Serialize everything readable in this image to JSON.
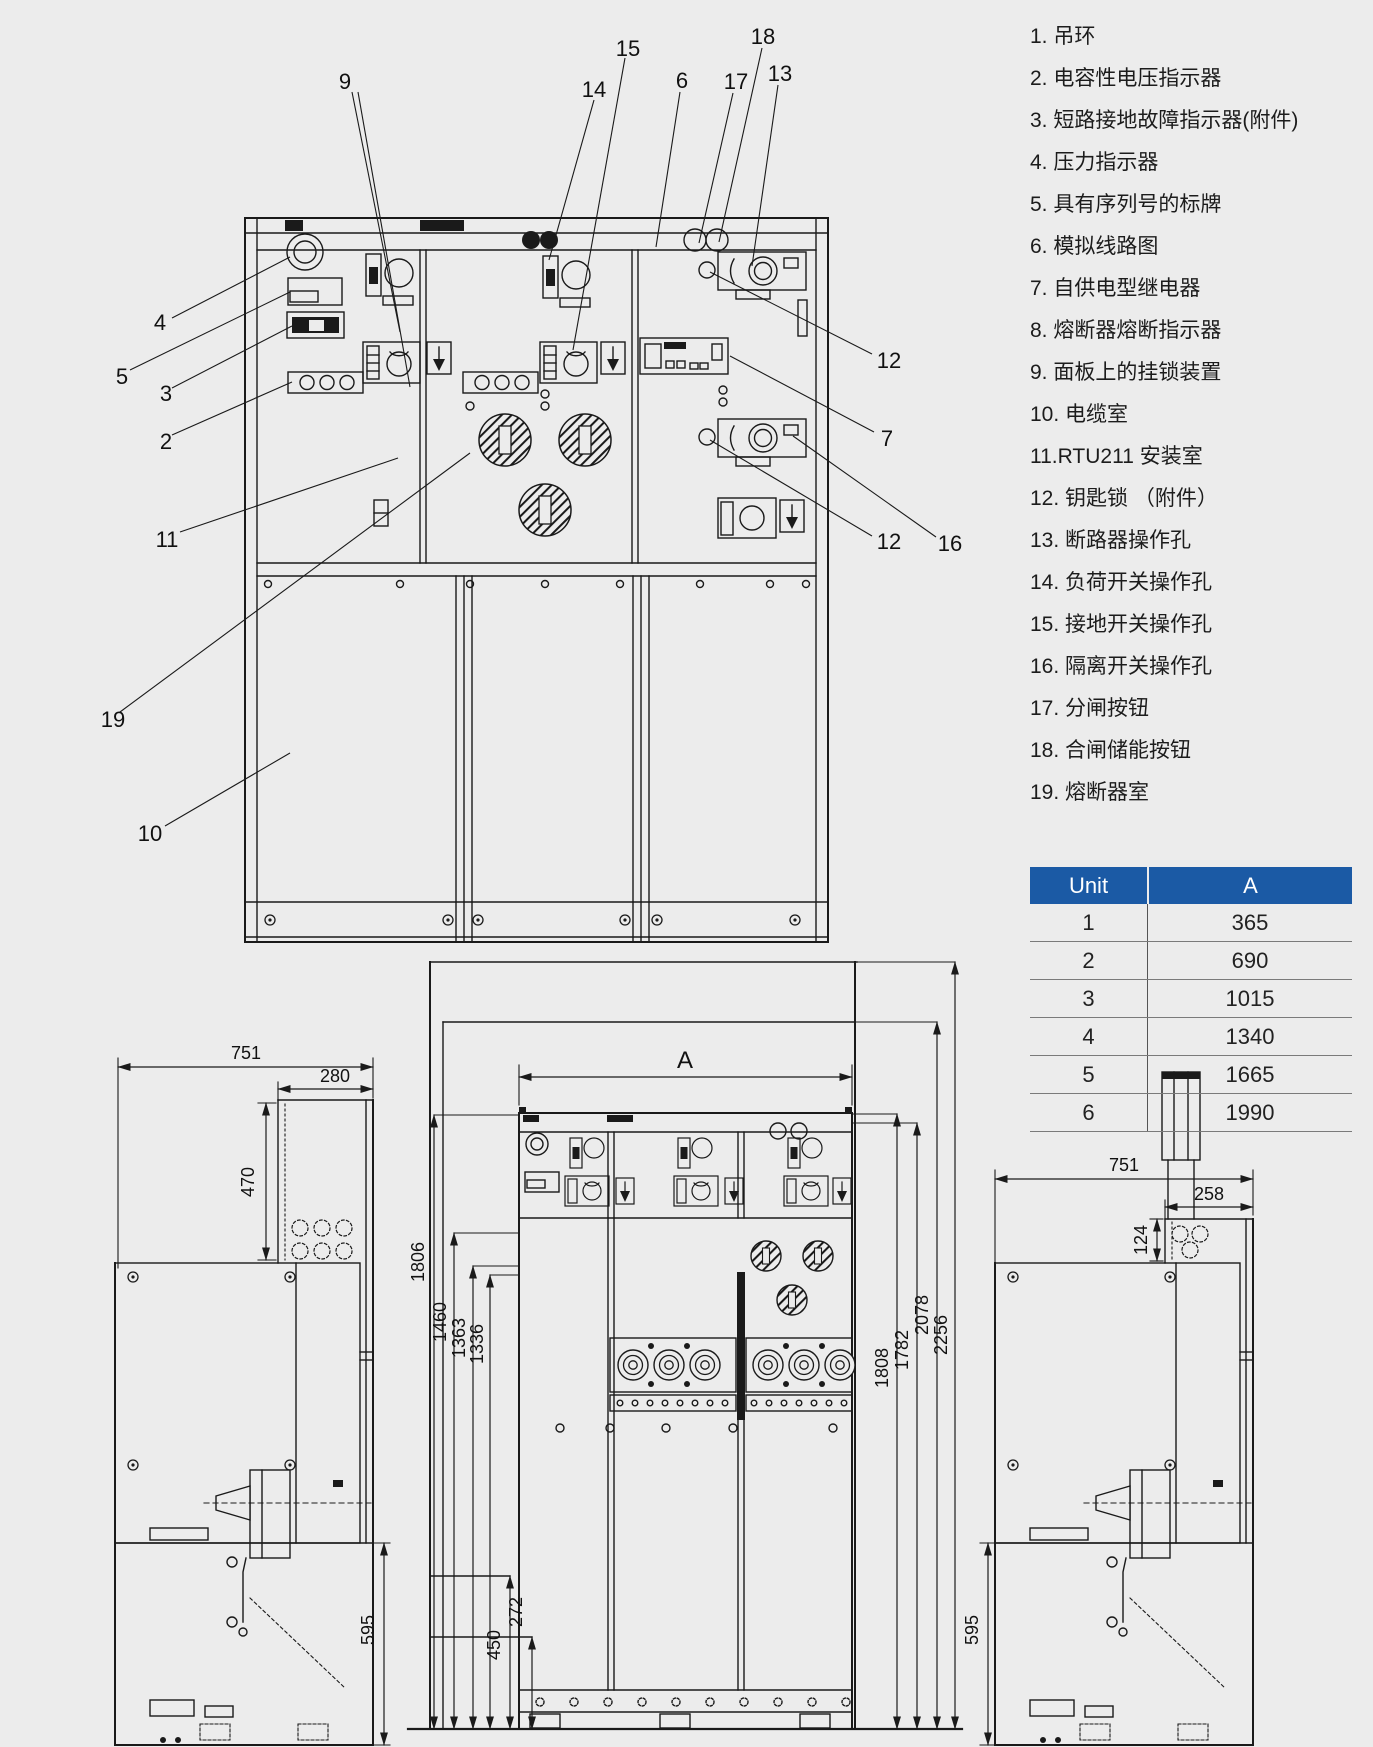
{
  "colors": {
    "background": "#ececec",
    "line": "#1a1a1a",
    "table_header_bg": "#1b5aa5",
    "table_header_text": "#ffffff"
  },
  "legend": {
    "items": [
      "1. 吊环",
      "2. 电容性电压指示器",
      "3. 短路接地故障指示器(附件)",
      "4. 压力指示器",
      "5. 具有序列号的标牌",
      "6. 模拟线路图",
      "7. 自供电型继电器",
      "8. 熔断器熔断指示器",
      "9. 面板上的挂锁装置",
      "10. 电缆室",
      "11.RTU211 安装室",
      "12. 钥匙锁 （附件）",
      "13. 断路器操作孔",
      "14. 负荷开关操作孔",
      "15. 接地开关操作孔",
      "16. 隔离开关操作孔",
      "17. 分闸按钮",
      "18. 合闸储能按钮",
      "19. 熔断器室"
    ]
  },
  "table": {
    "headers": [
      "Unit",
      "A"
    ],
    "rows": [
      [
        "1",
        "365"
      ],
      [
        "2",
        "690"
      ],
      [
        "3",
        "1015"
      ],
      [
        "4",
        "1340"
      ],
      [
        "5",
        "1665"
      ],
      [
        "6",
        "1990"
      ]
    ]
  },
  "main_view": {
    "callouts": [
      "9",
      "15",
      "14",
      "6",
      "17",
      "18",
      "13",
      "4",
      "5",
      "3",
      "2",
      "11",
      "19",
      "10",
      "12",
      "7",
      "12",
      "16"
    ]
  },
  "dims": {
    "left_view": {
      "depth": "751",
      "door_width": "280",
      "door_height": "470",
      "lower_height": "595"
    },
    "center_view": {
      "width_label": "A",
      "left": [
        "1806",
        "1460",
        "1363",
        "1336"
      ],
      "right": [
        "1808",
        "1782",
        "2078",
        "2256"
      ],
      "bottom": [
        "450",
        "272"
      ]
    },
    "right_view": {
      "depth": "751",
      "door_width": "258",
      "top_height": "124",
      "lower_height": "595"
    }
  }
}
